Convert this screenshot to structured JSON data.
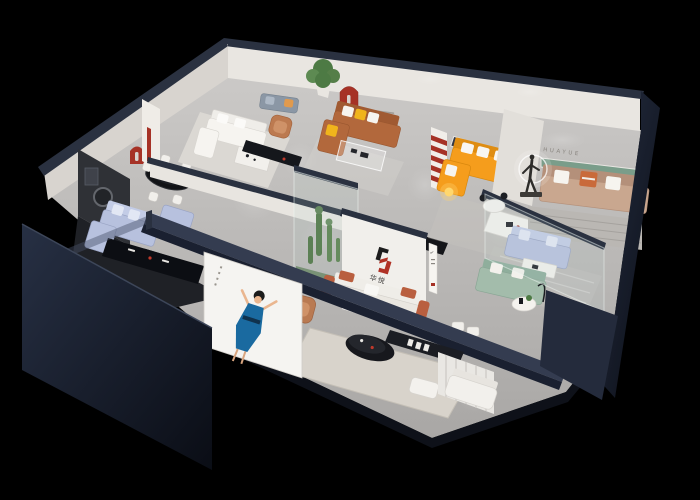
{
  "scene": {
    "description": "3D isometric cutaway render of a furniture brand showroom floor plan on a black background",
    "background_color": "#000000"
  },
  "brand": {
    "wall_sign": "HUAYUE",
    "logo_mark": "H",
    "logo_characters": "华悦",
    "sign_check_glyph": "✓"
  },
  "palette": {
    "exterior_wall_navy": "#2a3140",
    "interior_wall_white": "#ece9e4",
    "floor_gray": "#c0bebc",
    "accent_red": "#a63226",
    "sofa_orange": "#f59d1c",
    "sofa_caramel": "#b2683c",
    "sofa_light_blue": "#b7c1de",
    "sofa_sage_green": "#a3bcab",
    "sofa_beige": "#c9a78f",
    "pillow_yellow": "#f0b41c",
    "shelf_green": "#7a9d8a",
    "poster_dress_blue": "#1a6aa0",
    "glass_tint": "#bed7d2"
  },
  "displays": [
    {
      "label": "dark media lounge",
      "items": "light-blue sofa set, black oval dining table with white chairs, red arched niche, black media console"
    },
    {
      "label": "white living room set",
      "items": "white modular sofa, coffee table, leather armchair, potted tree, wall pillar with red accent"
    },
    {
      "label": "caramel sofa display",
      "items": "caramel sectional with yellow and white pillows, glass coffee table, red arched wall niche"
    },
    {
      "label": "orange sofa display",
      "items": "orange L-shaped sectional, white coffee table, red striped accent wall, bronze figure with halo ring light"
    },
    {
      "label": "HUAYUE lounge",
      "items": "beige three-seat sofa, recessed green shelf, HUAYUE wall lettering, striped rug"
    },
    {
      "label": "glass sofa gallery",
      "items": "light-blue sofa, sage-green sofa, round coffee tables, glass partitions"
    },
    {
      "label": "brand logo wall",
      "items": "white wall with red-and-black H logo above Chinese characters, vertical sign with check mark, glass plant atrium"
    },
    {
      "label": "front lounge strip",
      "items": "white and terracotta sofa, black oval coffee table, cream rug, white ottoman, low console, sheer curtains, white sofa"
    },
    {
      "label": "entry poster",
      "items": "illuminated poster of a woman in a blue dress with raised arms"
    }
  ]
}
